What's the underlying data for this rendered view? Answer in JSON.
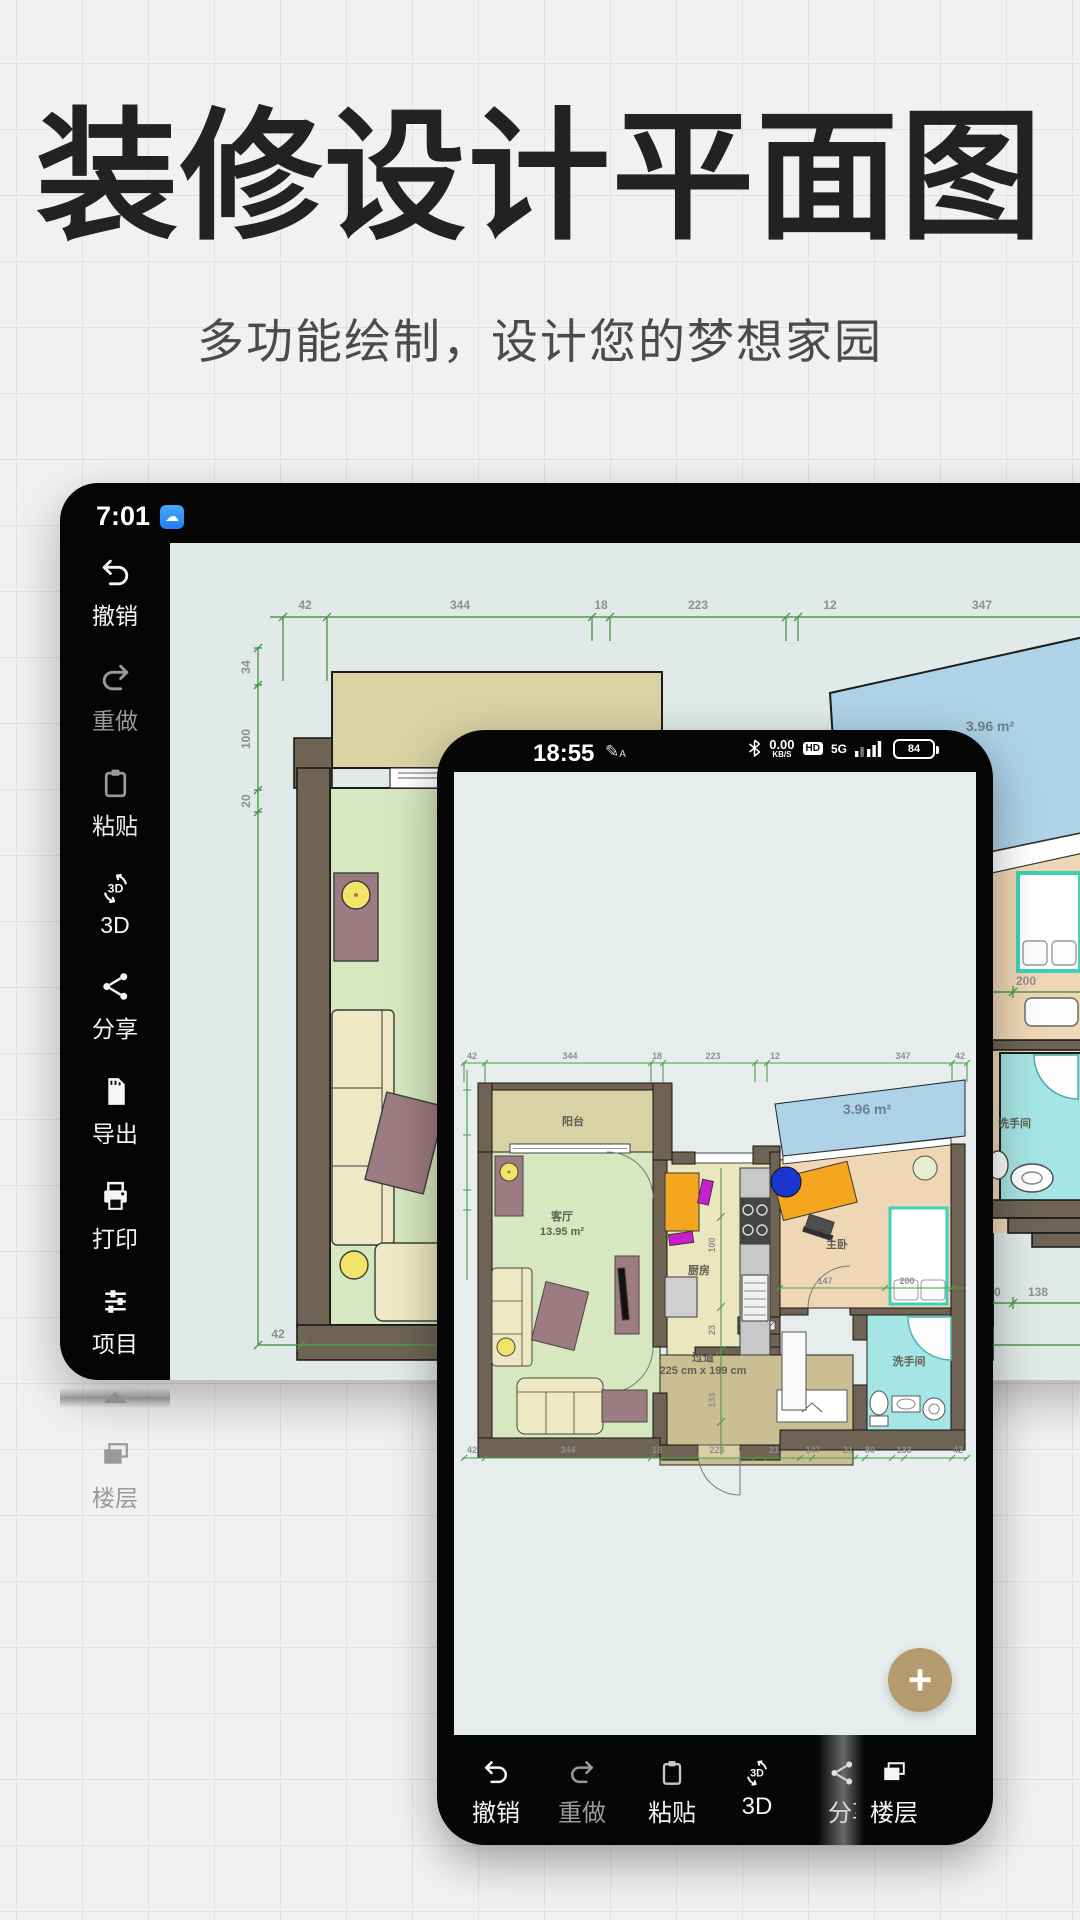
{
  "hero": {
    "title": "装修设计平面图",
    "subtitle": "多功能绘制，设计您的梦想家园"
  },
  "tablet": {
    "status": {
      "time": "7:01"
    },
    "toolbar": [
      {
        "label": "撤销"
      },
      {
        "label": "重做"
      },
      {
        "label": "粘贴"
      },
      {
        "label": "3D"
      },
      {
        "label": "分享"
      },
      {
        "label": "导出"
      },
      {
        "label": "打印"
      },
      {
        "label": "项目"
      },
      {
        "label": "楼层"
      }
    ],
    "plan": {
      "top_dims": [
        "42",
        "344",
        "18",
        "223",
        "12",
        "347"
      ],
      "left_dims": [
        "34",
        "100",
        "20"
      ],
      "bottom_left_dim": "42",
      "blue_area": "3.96 m²",
      "bed_dim": "200",
      "bath_label": "洗手间",
      "bottom_right_dims": [
        "0",
        "138"
      ]
    }
  },
  "phone": {
    "status": {
      "time": "18:55",
      "speed": "0.00",
      "speed_unit": "KB/S",
      "hd": "HD",
      "net": "5G",
      "battery": "84"
    },
    "plan": {
      "top_dims": [
        "42",
        "344",
        "18",
        "223",
        "12",
        "347",
        "42"
      ],
      "bottom_dims": [
        "42",
        "344",
        "18",
        "223",
        "21",
        "147",
        "21",
        "80",
        "133",
        "42"
      ],
      "inner_dims": {
        "v1": "100",
        "v2": "23",
        "v3": "133",
        "h1": "147",
        "h2": "200"
      },
      "rooms": {
        "balcony": "阳台",
        "living": "客厅",
        "living_area": "13.95 m²",
        "kitchen": "厨房",
        "bedroom": "主卧",
        "hall": "过道",
        "hall_size": "225 cm x 199 cm",
        "bath": "洗手间",
        "blue_area": "3.96 m²"
      }
    },
    "fab": "+",
    "toolbar": [
      {
        "label": "撤销"
      },
      {
        "label": "重做"
      },
      {
        "label": "粘贴"
      },
      {
        "label": "3D"
      },
      {
        "label": "分享"
      },
      {
        "label": "楼层"
      }
    ]
  }
}
